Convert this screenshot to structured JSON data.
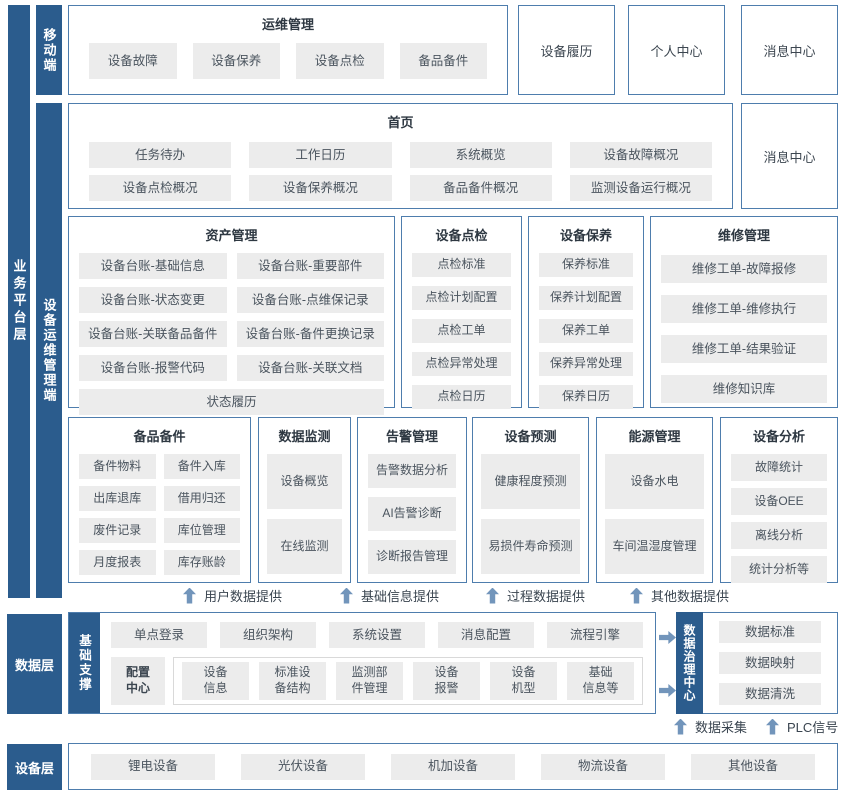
{
  "layer_labels": {
    "business": "业务平台层",
    "mobile": "移动端",
    "ops": "设备运维管理端",
    "data": "数据层",
    "device": "设备层"
  },
  "top": {
    "title": "运维管理",
    "items": [
      "设备故障",
      "设备保养",
      "设备点检",
      "备品备件"
    ],
    "cards": [
      "设备履历",
      "个人中心",
      "消息中心"
    ]
  },
  "home": {
    "title": "首页",
    "row1": [
      "任务待办",
      "工作日历",
      "系统概览",
      "设备故障概况"
    ],
    "row2": [
      "设备点检概况",
      "设备保养概况",
      "备品备件概况",
      "监测设备运行概况"
    ],
    "card": "消息中心"
  },
  "asset": {
    "title": "资产管理",
    "items": [
      "设备台账-基础信息",
      "设备台账-重要部件",
      "设备台账-状态变更",
      "设备台账-点维保记录",
      "设备台账-关联备品备件",
      "设备台账-备件更换记录",
      "设备台账-报警代码",
      "设备台账-关联文档"
    ],
    "full": "状态履历"
  },
  "inspection": {
    "title": "设备点检",
    "items": [
      "点检标准",
      "点检计划配置",
      "点检工单",
      "点检异常处理",
      "点检日历"
    ]
  },
  "maintenance": {
    "title": "设备保养",
    "items": [
      "保养标准",
      "保养计划配置",
      "保养工单",
      "保养异常处理",
      "保养日历"
    ]
  },
  "repair": {
    "title": "维修管理",
    "items": [
      "维修工单-故障报修",
      "维修工单-维修执行",
      "维修工单-结果验证",
      "维修知识库"
    ]
  },
  "spare": {
    "title": "备品备件",
    "items": [
      "备件物料",
      "备件入库",
      "出库退库",
      "借用归还",
      "废件记录",
      "库位管理",
      "月度报表",
      "库存账龄"
    ]
  },
  "monitor": {
    "title": "数据监测",
    "items": [
      "设备概览",
      "在线监测"
    ]
  },
  "alarm": {
    "title": "告警管理",
    "items": [
      "告警数据分析",
      "AI告警诊断",
      "诊断报告管理"
    ]
  },
  "predict": {
    "title": "设备预测",
    "items": [
      "健康程度预测",
      "易损件寿命预测"
    ]
  },
  "energy": {
    "title": "能源管理",
    "items": [
      "设备水电",
      "车间温湿度管理"
    ]
  },
  "analysis": {
    "title": "设备分析",
    "items": [
      "故障统计",
      "设备OEE",
      "离线分析",
      "统计分析等"
    ]
  },
  "flows": [
    "用户数据提供",
    "基础信息提供",
    "过程数据提供",
    "其他数据提供"
  ],
  "support": {
    "label": "基础支撑",
    "row1": [
      "单点登录",
      "组织架构",
      "系统设置",
      "消息配置",
      "流程引擎"
    ],
    "config": "配置\n中心",
    "row2": [
      "设备\n信息",
      "标准设\n备结构",
      "监测部\n件管理",
      "设备\n报警",
      "设备\n机型",
      "基础\n信息等"
    ]
  },
  "governance": {
    "label": "数据治理中心",
    "items": [
      "数据标准",
      "数据映射",
      "数据清洗"
    ]
  },
  "bottom_flows": [
    "数据采集",
    "PLC信号"
  ],
  "device": {
    "items": [
      "锂电设备",
      "光伏设备",
      "机加设备",
      "物流设备",
      "其他设备"
    ]
  },
  "colors": {
    "bar_bg": "#2b5c8d",
    "box_border": "#4e7dad",
    "chip_bg": "#ececec",
    "arrow": "#7295bb"
  }
}
